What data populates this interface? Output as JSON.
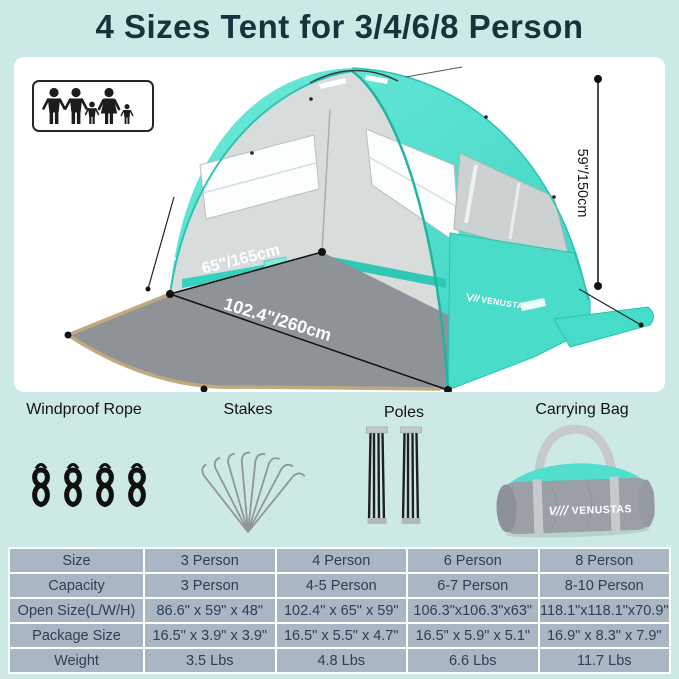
{
  "title": "4 Sizes Tent for 3/4/6/8 Person",
  "tent": {
    "brand": "VENUSTAS",
    "width_label": "65\"/165cm",
    "depth_label": "102.4\"/260cm",
    "height_label": "59\"/150cm"
  },
  "accessories": {
    "rope_label": "Windproof Rope",
    "stakes_label": "Stakes",
    "poles_label": "Poles",
    "bag_label": "Carrying Bag",
    "bag_brand": "VENUSTAS"
  },
  "icons": {
    "family": "family-pictogram-icon",
    "rope": "rope-coil-icon",
    "stakes": "stakes-fan-icon",
    "poles": "folded-poles-icon",
    "bag": "carrying-bag-icon"
  },
  "colors": {
    "background": "#cde9e5",
    "panel": "#ffffff",
    "tent_teal": "#47ddca",
    "floor_gray": "#8e9397",
    "floor_trim": "#c2a87e",
    "table_cell": "#a9b6c3",
    "table_text": "#2f4052",
    "title_text": "#16343c"
  },
  "table": {
    "rows": [
      {
        "label": "Size",
        "values": [
          "3 Person",
          "4 Person",
          "6 Person",
          "8 Person"
        ]
      },
      {
        "label": "Capacity",
        "values": [
          "3 Person",
          "4-5 Person",
          "6-7 Person",
          "8-10 Person"
        ]
      },
      {
        "label": "Open Size(L/W/H)",
        "values": [
          "86.6\" x 59\" x 48\"",
          "102.4\" x 65\" x 59\"",
          "106.3\"x106.3\"x63\"",
          "118.1\"x118.1\"x70.9\""
        ]
      },
      {
        "label": "Package Size",
        "values": [
          "16.5\" x 3.9\" x 3.9\"",
          "16.5\" x 5.5\" x 4.7\"",
          "16.5\" x 5.9\" x 5.1\"",
          "16.9\" x 8.3\" x 7.9\""
        ]
      },
      {
        "label": "Weight",
        "values": [
          "3.5 Lbs",
          "4.8 Lbs",
          "6.6 Lbs",
          "11.7 Lbs"
        ]
      }
    ]
  }
}
